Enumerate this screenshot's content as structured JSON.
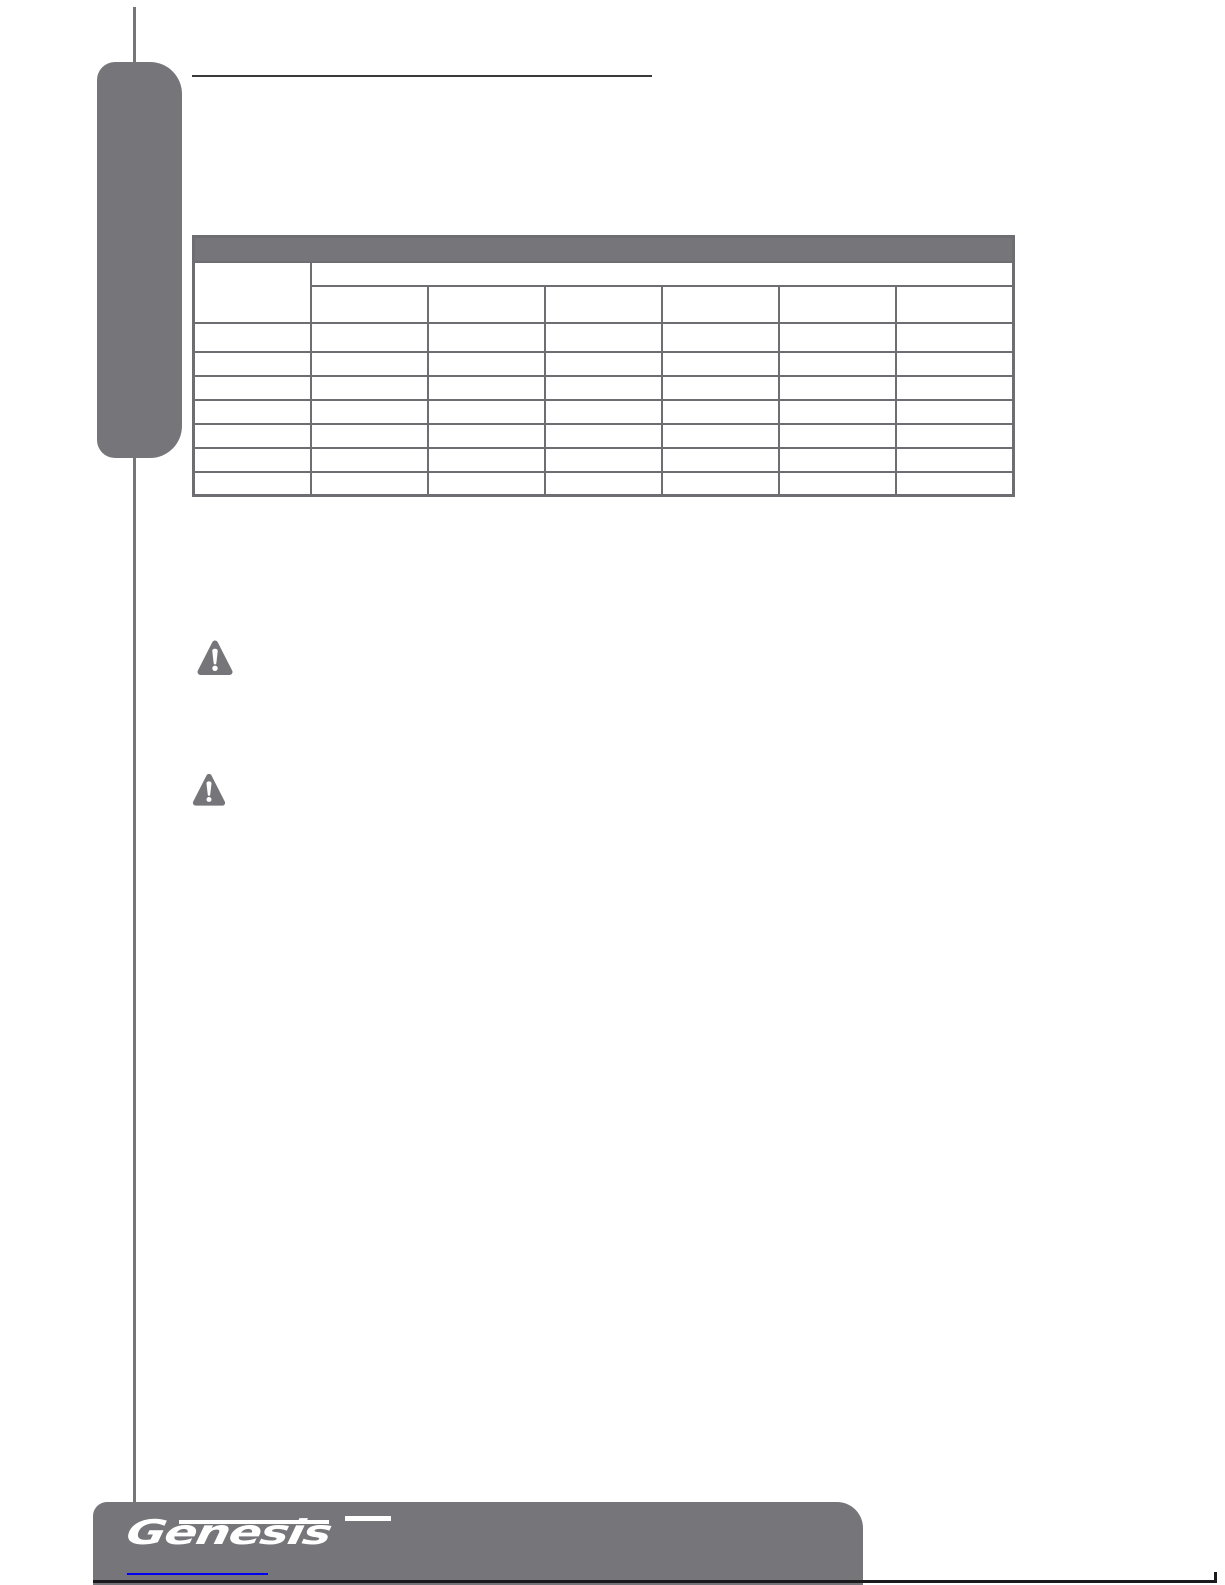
{
  "colors": {
    "background": "#ffffff",
    "gray": "#76767a",
    "table_border": "#6e6e72",
    "heading_rule": "#3a3a3a",
    "footer_rule": "#1b1b1d",
    "link": "#0000ee"
  },
  "heading": {
    "text": ""
  },
  "spec_table": {
    "banner_label": "",
    "row_header_label": "",
    "group_header_label": "",
    "column_headers": [
      "",
      "",
      "",
      "",
      "",
      ""
    ],
    "data_rows": [
      [
        "",
        "",
        "",
        "",
        "",
        "",
        ""
      ],
      [
        "",
        "",
        "",
        "",
        "",
        "",
        ""
      ],
      [
        "",
        "",
        "",
        "",
        "",
        "",
        ""
      ],
      [
        "",
        "",
        "",
        "",
        "",
        "",
        ""
      ],
      [
        "",
        "",
        "",
        "",
        "",
        "",
        ""
      ],
      [
        "",
        "",
        "",
        "",
        "",
        "",
        ""
      ],
      [
        "",
        "",
        "",
        "",
        "",
        "",
        ""
      ]
    ]
  },
  "warning_icons": [
    {
      "name": "warning-icon"
    },
    {
      "name": "warning-icon"
    }
  ],
  "footer": {
    "logo_text": "Genesis",
    "link_text": ""
  }
}
